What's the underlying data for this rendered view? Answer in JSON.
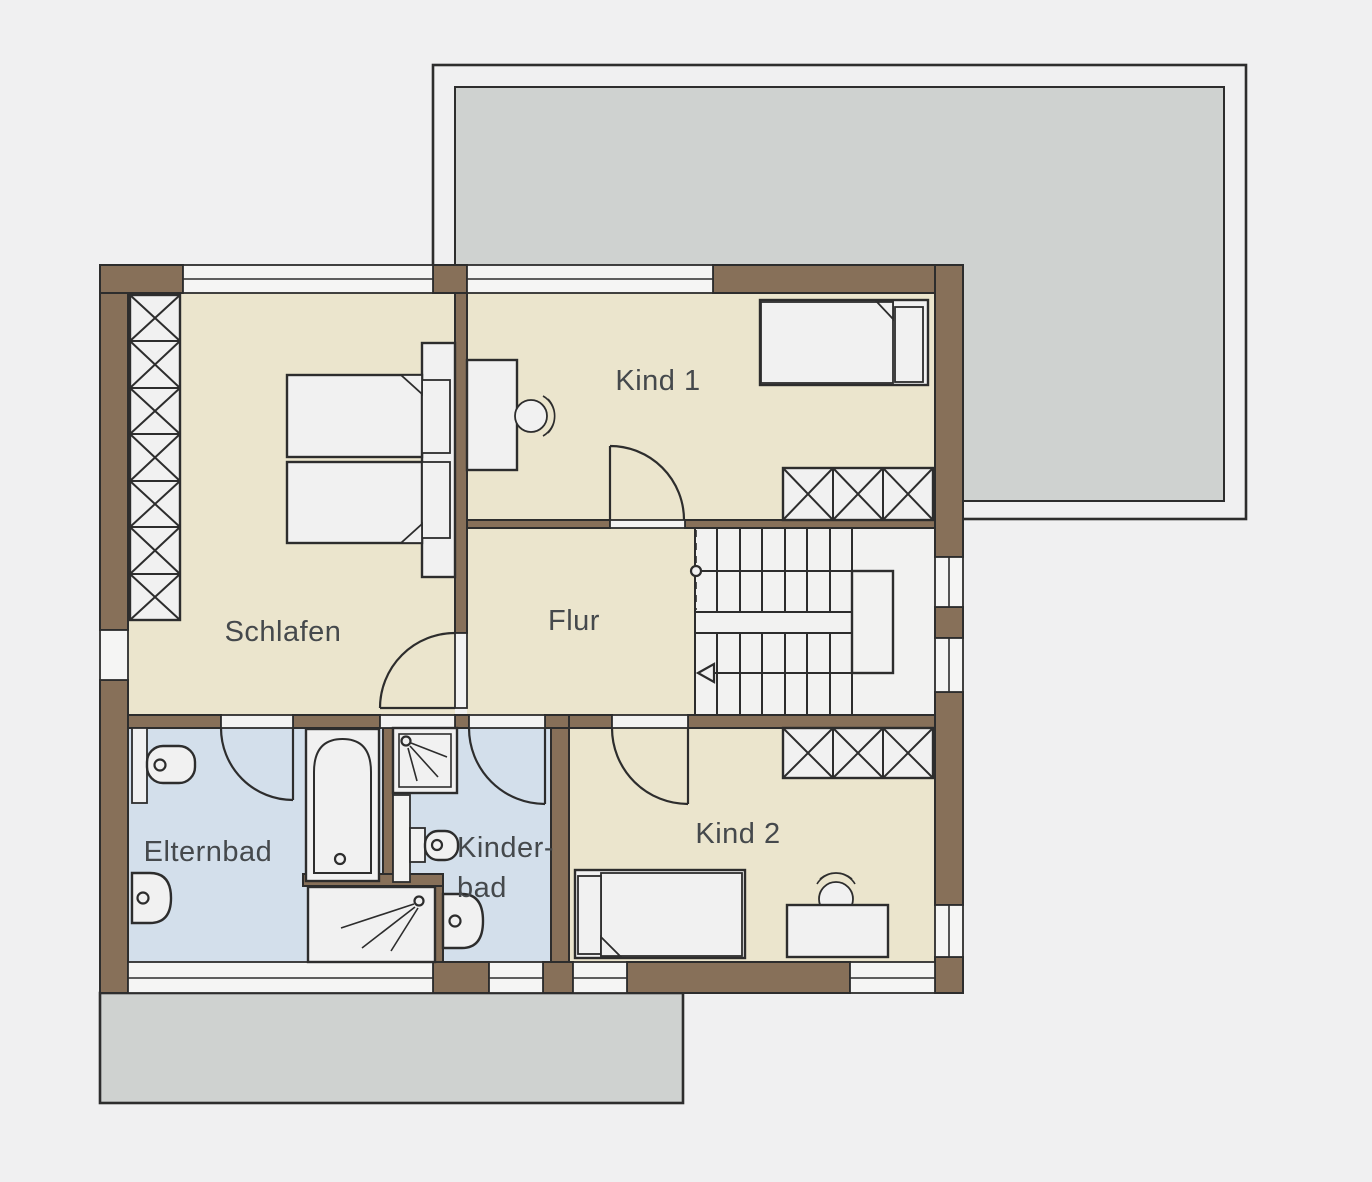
{
  "title": "Obergeschoss Grundriss (floor plan, upper storey)",
  "rooms": {
    "schlafen": {
      "label": "Schlafen"
    },
    "kind1": {
      "label": "Kind 1"
    },
    "flur": {
      "label": "Flur"
    },
    "kind2": {
      "label": "Kind 2"
    },
    "elternbad": {
      "label": "Elternbad"
    },
    "kinderbad": {
      "label_line1": "Kinder-",
      "label_line2": "bad"
    }
  },
  "areas": {
    "terrace": "roof terrace (top)",
    "balcony": "balcony (bottom)",
    "stairs": "u-shaped staircase"
  },
  "fixtures": [
    "double-bed",
    "wardrobe",
    "single-bed",
    "desk",
    "desk-chair",
    "bathtub",
    "shower",
    "toilet",
    "washbasin",
    "stairs"
  ],
  "colors": {
    "background": "#f0f0f1",
    "wall": "#877059",
    "outline": "#2d2d2d",
    "floor_living": "#ebe5cd",
    "floor_bath": "#d3dfeb",
    "terrace_gray": "#cfd2d0",
    "stairs_white": "#f2f2f1",
    "label_text": "#45494c"
  }
}
